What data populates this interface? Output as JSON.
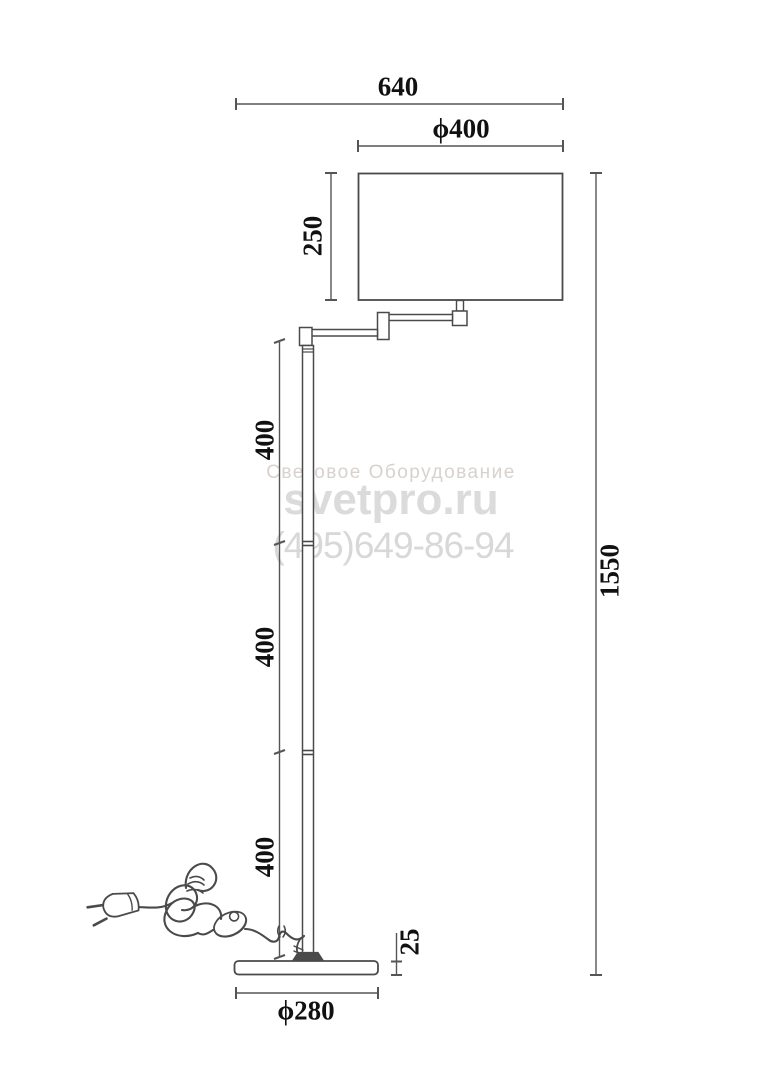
{
  "colors": {
    "line": "#4a4a4a",
    "dim_line": "#555555",
    "label_text": "#111111",
    "watermark_tagline": "#d8d1ce",
    "watermark_site": "#dbdbdb",
    "watermark_phone": "#d8d8d8"
  },
  "watermark": {
    "tagline": "Световое Оборудование",
    "site": "svetpro.ru",
    "phone": "(495)649-86-94"
  },
  "dims": {
    "overall_width": "640",
    "shade_diameter": "ϕ400",
    "shade_height": "250",
    "overall_height": "1550",
    "pole_segments": [
      "400",
      "400",
      "400"
    ],
    "base_height": "25",
    "base_diameter": "ϕ280"
  }
}
